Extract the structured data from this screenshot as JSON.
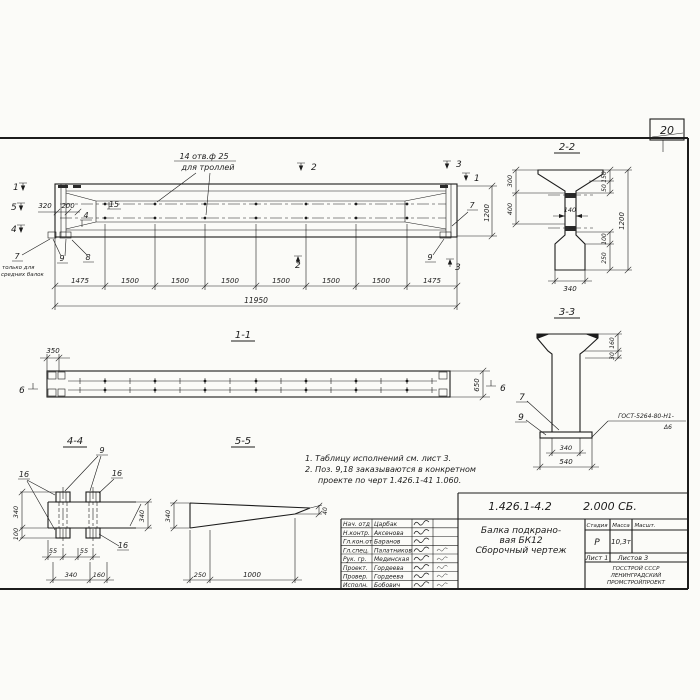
{
  "sheet": {
    "page_number": "20"
  },
  "main_view": {
    "holes_note_1": "14 отв.ф 25",
    "holes_note_2": "для троллей",
    "left_note_1": "только для",
    "left_note_2": "средних балок",
    "pos_7_left": "7",
    "pos_9_left": "9",
    "pos_8": "8",
    "pos_15": "15",
    "pos_4": "4",
    "pos_7_right": "7",
    "pos_9_right": "9",
    "cut_1_left": "1",
    "cut_5_left": "5",
    "cut_4_left": "4",
    "cut_2_top": "2",
    "cut_2_bottom": "2",
    "cut_3_top": "3",
    "cut_3_bottom": "3",
    "cut_1_right": "1",
    "dim_320": "320",
    "dim_200": "200",
    "dim_1200": "1200",
    "dim_total": "11950",
    "chain": [
      "1475",
      "1500",
      "1500",
      "1500",
      "1500",
      "1500",
      "1500",
      "1475"
    ]
  },
  "section_1_1": {
    "title": "1-1",
    "dim_350": "350",
    "dim_650": "650",
    "cut_6_left": "6",
    "cut_6_right": "6"
  },
  "detail_4_4": {
    "title": "4-4",
    "pos_9": "9",
    "pos_16_left": "16",
    "pos_16_right": "16",
    "pos_16_bottom": "16",
    "dim_340_left": "340",
    "dim_100_left": "100",
    "dim_340_right": "340",
    "dim_55_a": "55",
    "dim_55_b": "55",
    "dim_340_bottom": "340",
    "dim_160_bottom": "160"
  },
  "detail_5_5": {
    "title": "5-5",
    "dim_340": "340",
    "dim_40": "40",
    "dim_250": "250",
    "dim_1000": "1000"
  },
  "notes": {
    "line1": "1. Таблицу исполнений см. лист 3.",
    "line2": "2. Поз. 9,18 заказываются в конкретном",
    "line3": "проекте по черт 1.426.1-41 1.060."
  },
  "section_2_2": {
    "title": "2-2",
    "dim_300": "300",
    "dim_400": "400",
    "dim_140": "140",
    "dim_150": "150",
    "dim_50": "50",
    "dim_1200": "1200",
    "dim_100": "100",
    "dim_250": "250",
    "dim_340": "340"
  },
  "section_3_3": {
    "title": "3-3",
    "pos_7": "7",
    "pos_9": "9",
    "dim_160": "160",
    "dim_30": "30",
    "dim_340": "340",
    "dim_540": "540",
    "weld_note_1": "ГОСТ-5264-80-Н1-",
    "weld_note_2": "Δ6"
  },
  "title_block": {
    "doc_number": "1.426.1-4.2",
    "doc_code": "2.000 СБ.",
    "title_line_1": "Балка подкрано-",
    "title_line_2": "вая БК12",
    "title_line_3": "Сборочный  чертеж",
    "col_stage": "Стадия",
    "col_mass": "Масса",
    "col_scale": "Масшт.",
    "val_stage": "Р",
    "val_mass": "10,3т",
    "sheet_no": "Лист 1",
    "sheets_total": "Листов 3",
    "org_line_1": "ГОССТРОЙ СССР",
    "org_line_2": "ЛЕНИНГРАДСКИЙ",
    "org_line_3": "ПРОМСТРОЙПРОЕКТ",
    "rows": [
      {
        "role": "Нач. отд",
        "name": "Царбак"
      },
      {
        "role": "Н.контр.",
        "name": "Аксенова"
      },
      {
        "role": "Гл.кон.от",
        "name": "Баранов"
      },
      {
        "role": "Гл.спец.",
        "name": "Палатников"
      },
      {
        "role": "Рук. гр.",
        "name": "Мединская"
      },
      {
        "role": "Проект.",
        "name": "Гордеева"
      },
      {
        "role": "Провер.",
        "name": "Гордеева"
      },
      {
        "role": "Исполн.",
        "name": "Бобович"
      }
    ]
  }
}
